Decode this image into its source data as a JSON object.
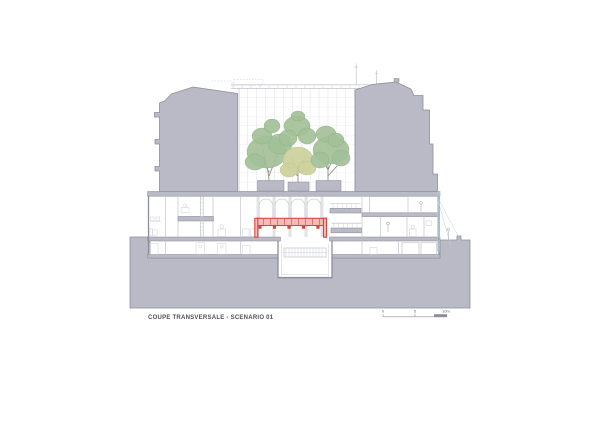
{
  "drawing": {
    "title": "COUPE TRANSVERSALE - SCENARIO 01",
    "scale_bar": {
      "labels": [
        "0",
        "5",
        "10m"
      ]
    },
    "scene": {
      "tree_count": 3
    },
    "colors": {
      "page": "#ffffff",
      "poche_gray": "#b9bac5",
      "outline_gray": "#8e8f9b",
      "line_gray": "#b9bac6",
      "line_light": "#ccced8",
      "glass_mullion": "#cdced8",
      "glass_grid": "#dcdde5",
      "foliage_green": "#a3c098",
      "foliage_yellow": "#cdd29e",
      "trunk": "#8f9088",
      "highlight_red": "#d6463e",
      "highlight_red_fill": "#f5bcb7",
      "ladder_cyan": "#8fd8e2",
      "text_dark": "#4e4f57"
    }
  }
}
